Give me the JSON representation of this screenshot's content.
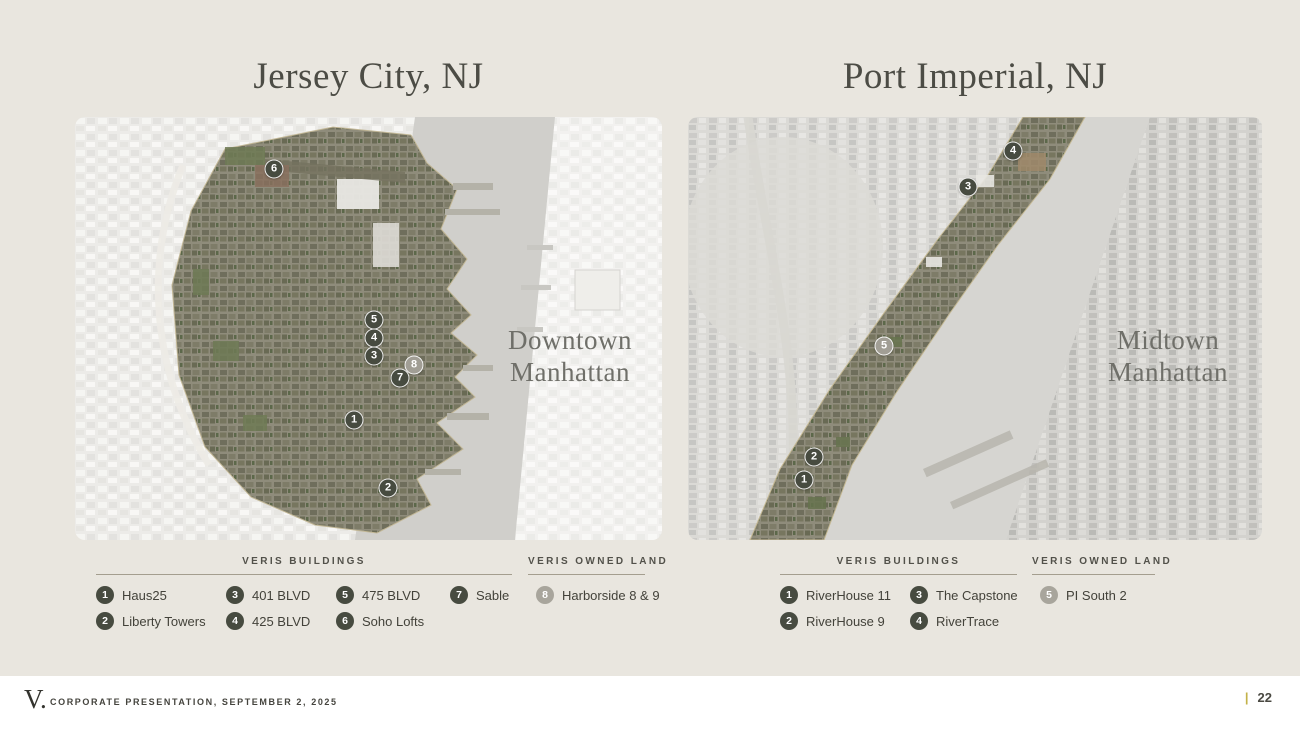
{
  "slide": {
    "background_color": "#e9e6df",
    "accent_gold": "#c3b24a",
    "marker_dark_color": "#474b40",
    "marker_gray_color": "#a8a59c"
  },
  "maps": [
    {
      "id": "jersey-city",
      "title": "Jersey City, NJ",
      "overlay_label": [
        "Downtown",
        "Manhattan"
      ],
      "markers": [
        {
          "num": "6",
          "x": 199,
          "y": 52,
          "type": "dark"
        },
        {
          "num": "5",
          "x": 299,
          "y": 203,
          "type": "dark"
        },
        {
          "num": "4",
          "x": 299,
          "y": 221,
          "type": "dark"
        },
        {
          "num": "3",
          "x": 299,
          "y": 239,
          "type": "dark"
        },
        {
          "num": "8",
          "x": 339,
          "y": 248,
          "type": "gray"
        },
        {
          "num": "7",
          "x": 325,
          "y": 261,
          "type": "dark"
        },
        {
          "num": "1",
          "x": 279,
          "y": 303,
          "type": "dark"
        },
        {
          "num": "2",
          "x": 313,
          "y": 371,
          "type": "dark"
        }
      ]
    },
    {
      "id": "port-imperial",
      "title": "Port Imperial, NJ",
      "overlay_label": [
        "Midtown",
        "Manhattan"
      ],
      "markers": [
        {
          "num": "4",
          "x": 325,
          "y": 34,
          "type": "dark"
        },
        {
          "num": "3",
          "x": 280,
          "y": 70,
          "type": "dark"
        },
        {
          "num": "5",
          "x": 196,
          "y": 229,
          "type": "gray"
        },
        {
          "num": "2",
          "x": 126,
          "y": 340,
          "type": "dark"
        },
        {
          "num": "1",
          "x": 116,
          "y": 363,
          "type": "dark"
        }
      ]
    }
  ],
  "legends": [
    {
      "map": "jersey-city",
      "sections": [
        {
          "title": "VERIS BUILDINGS",
          "items": [
            {
              "num": "1",
              "label": "Haus25",
              "type": "dark"
            },
            {
              "num": "2",
              "label": "Liberty Towers",
              "type": "dark"
            },
            {
              "num": "3",
              "label": "401 BLVD",
              "type": "dark"
            },
            {
              "num": "4",
              "label": "425 BLVD",
              "type": "dark"
            },
            {
              "num": "5",
              "label": "475 BLVD",
              "type": "dark"
            },
            {
              "num": "6",
              "label": "Soho Lofts",
              "type": "dark"
            },
            {
              "num": "7",
              "label": "Sable",
              "type": "dark"
            }
          ]
        },
        {
          "title": "VERIS OWNED LAND",
          "items": [
            {
              "num": "8",
              "label": "Harborside 8 & 9",
              "type": "gray"
            }
          ]
        }
      ]
    },
    {
      "map": "port-imperial",
      "sections": [
        {
          "title": "VERIS BUILDINGS",
          "items": [
            {
              "num": "1",
              "label": "RiverHouse 11",
              "type": "dark"
            },
            {
              "num": "2",
              "label": "RiverHouse 9",
              "type": "dark"
            },
            {
              "num": "3",
              "label": "The Capstone",
              "type": "dark"
            },
            {
              "num": "4",
              "label": "RiverTrace",
              "type": "dark"
            }
          ]
        },
        {
          "title": "VERIS OWNED LAND",
          "items": [
            {
              "num": "5",
              "label": "PI South 2",
              "type": "gray"
            }
          ]
        }
      ]
    }
  ],
  "footer": {
    "logo": "V.",
    "text": "CORPORATE PRESENTATION, SEPTEMBER 2, 2025",
    "page_separator": "|",
    "page_number": "22"
  }
}
